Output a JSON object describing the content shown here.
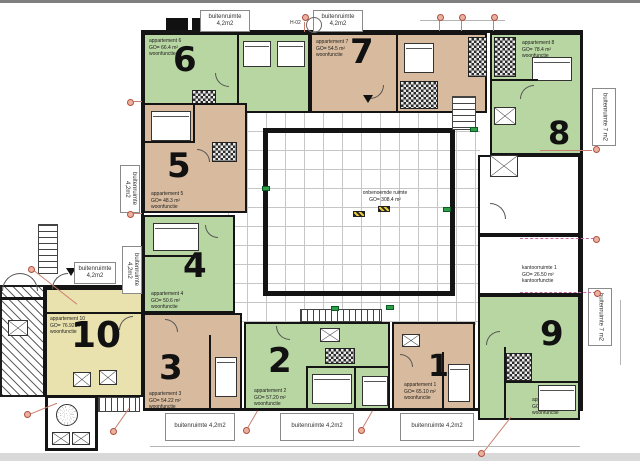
{
  "colors": {
    "apartment_green": "#b8d6a2",
    "apartment_tan": "#d8bb9e",
    "apartment_yellow": "#e9e2ae",
    "wall": "#141414",
    "marker_red": "#b05040",
    "exit_green": "#2f9e49"
  },
  "plan": {
    "center_room": {
      "name": "onbenoemde ruimte",
      "area": "GO= 308.4 m²"
    },
    "office": {
      "line1": "kantoorruimte 1",
      "line2": "GO= 26.50 m²",
      "line3": "kantoorfunctie"
    },
    "marker_label": "H-02",
    "apartments": [
      {
        "num": "1",
        "name": "appartement 1",
        "area": "GO= 65.10 m²",
        "func": "woonfunctie"
      },
      {
        "num": "2",
        "name": "appartement 2",
        "area": "GO= 57.20 m²",
        "func": "woonfunctie"
      },
      {
        "num": "3",
        "name": "appartement 3",
        "area": "GO= 54.22 m²",
        "func": "woonfunctie"
      },
      {
        "num": "4",
        "name": "appartement 4",
        "area": "GO= 50.6 m²",
        "func": "woonfunctie"
      },
      {
        "num": "5",
        "name": "appartement 5",
        "area": "GO= 48.3 m²",
        "func": "woonfunctie"
      },
      {
        "num": "6",
        "name": "appartement 6",
        "area": "GO= 66.4 m²",
        "func": "woonfunctie"
      },
      {
        "num": "7",
        "name": "appartement 7",
        "area": "GO= 54.5 m²",
        "func": "woonfunctie"
      },
      {
        "num": "8",
        "name": "appartement 8",
        "area": "GO= 78.4 m²",
        "func": "woonfunctie"
      },
      {
        "num": "9",
        "name": "appartement 9",
        "area": "GO= 66.80 m²",
        "func": "woonfunctie"
      },
      {
        "num": "10",
        "name": "appartement 10",
        "area": "GO= 76.92 m²",
        "func": "woonfunctie"
      }
    ],
    "balconies": [
      {
        "label": "buitenruimte 4,2m2"
      },
      {
        "label": "buitenruimte 4,2m2"
      },
      {
        "label": "buitenruimte 7 m2"
      },
      {
        "label": "buitenruimte 7 m2"
      },
      {
        "label": "buitenruimte 4,2m2"
      },
      {
        "label": "buitenruimte 4,2m2"
      },
      {
        "label": "buitenruimte 4,2m2"
      },
      {
        "label": "buitenruimte 4,2m2"
      },
      {
        "label": "buitenruimte 4,2m2"
      },
      {
        "label": "buitenruimte 4,2m2"
      }
    ]
  }
}
